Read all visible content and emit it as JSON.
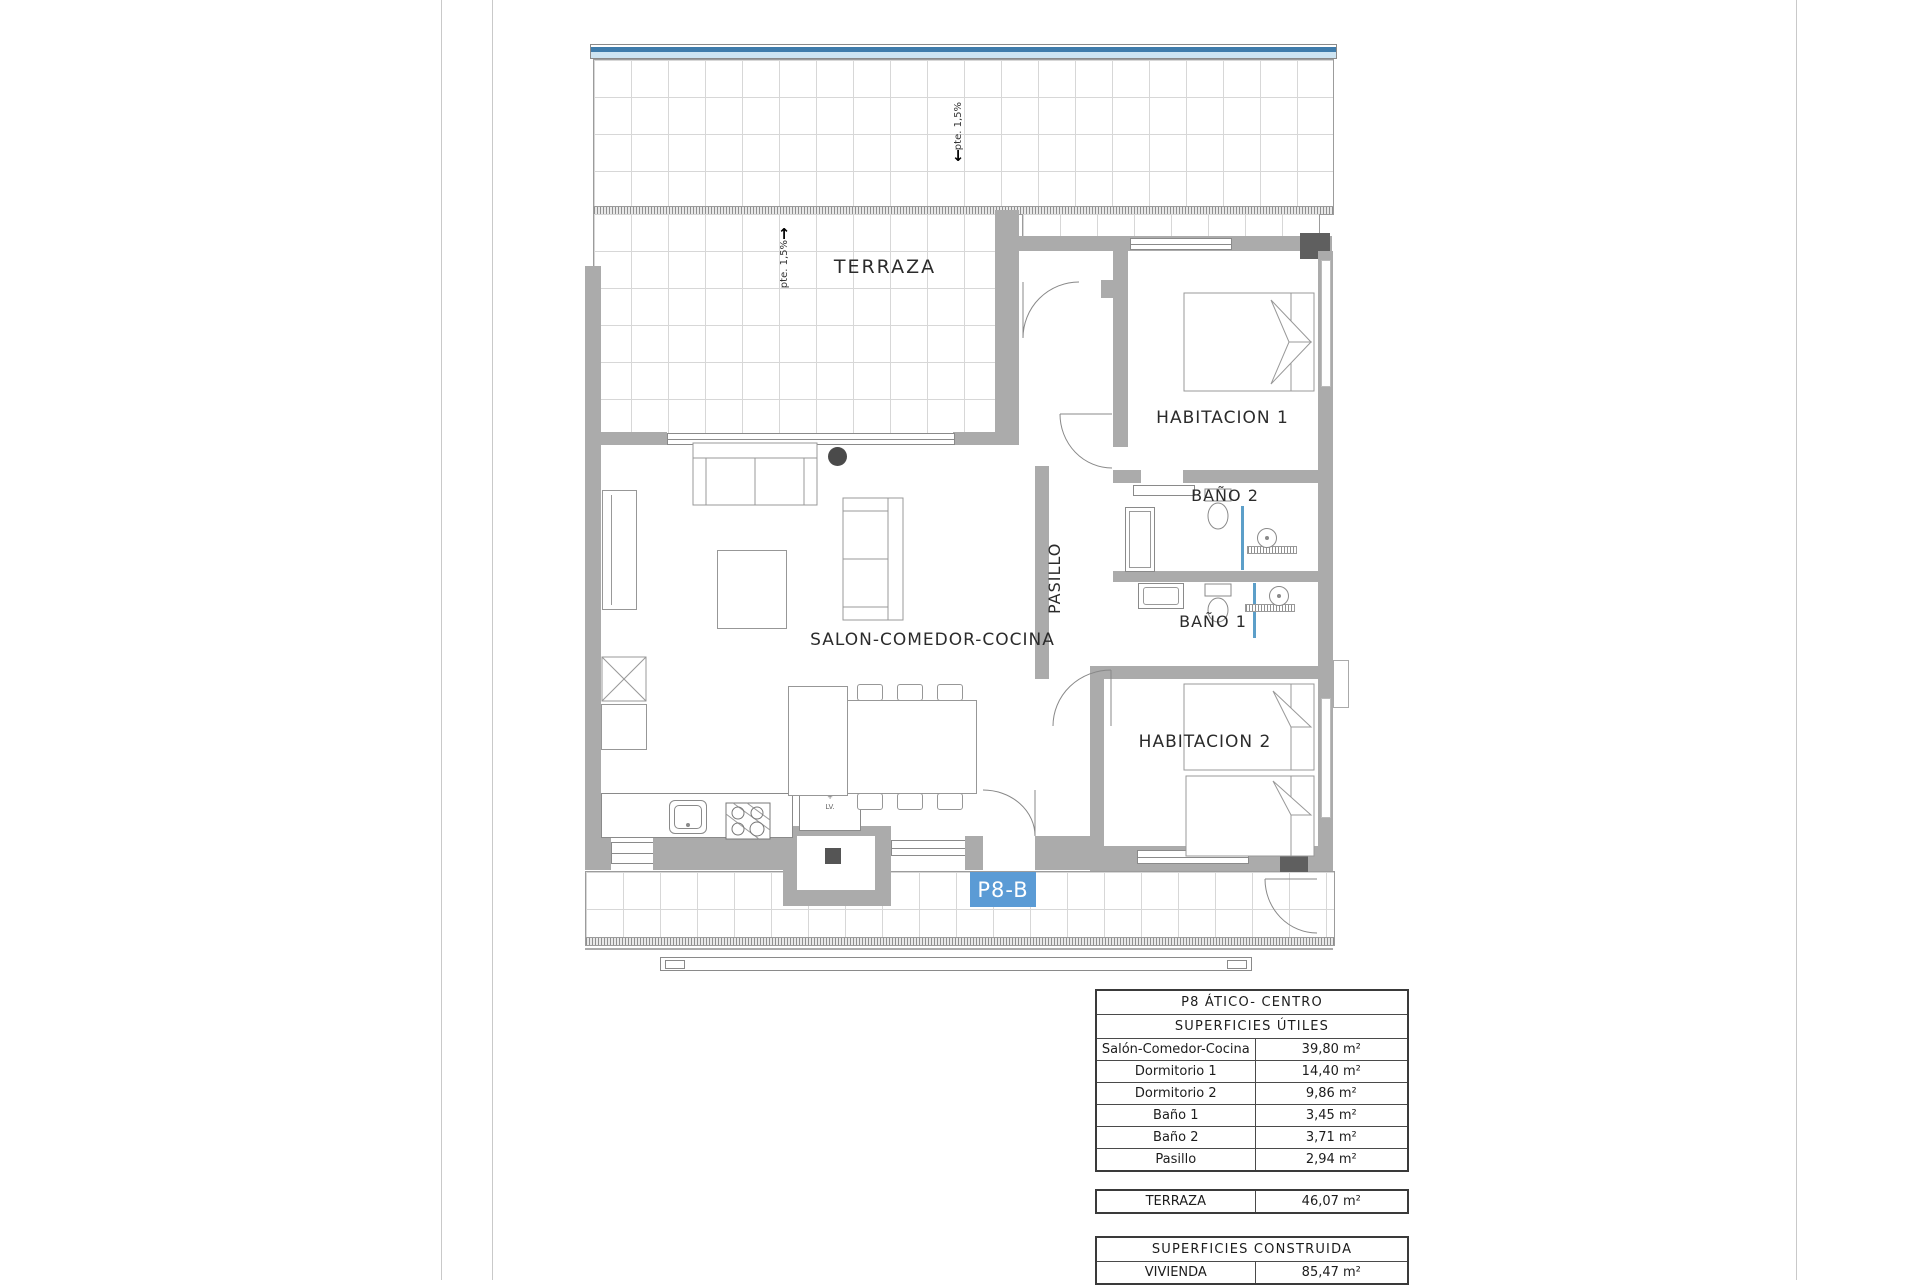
{
  "plan": {
    "unit_label": "P8-B",
    "labels": {
      "terraza": "TERRAZA",
      "habitacion1": "HABITACION 1",
      "habitacion2": "HABITACION 2",
      "bano1": "BAÑO 1",
      "bano2": "BAÑO 2",
      "pasillo": "PASILLO",
      "salon": "SALON-COMEDOR-COCINA"
    },
    "annotations": {
      "slope": "pte. 1,5%",
      "slope_arrow_up": "↑",
      "slope_arrow_down": "↓",
      "laundry_closet_line1": "secadora",
      "laundry_closet_line2": "+",
      "laundry_closet_line3": "LV."
    },
    "colors": {
      "wall_grey": "#ababab",
      "badge_blue": "#5b9bd5",
      "railing_blue_dark": "#3f7cab",
      "railing_blue_light": "#cde4f2",
      "glass_blue": "#5c9fc9"
    }
  },
  "tables": {
    "main": {
      "title": "P8 ÁTICO- CENTRO",
      "subtitle": "SUPERFICIES ÚTILES",
      "rows": [
        {
          "name": "Salón-Comedor-Cocina",
          "area": "39,80 m²"
        },
        {
          "name": "Dormitorio 1",
          "area": "14,40 m²"
        },
        {
          "name": "Dormitorio 2",
          "area": "9,86 m²"
        },
        {
          "name": "Baño 1",
          "area": "3,45 m²"
        },
        {
          "name": "Baño 2",
          "area": "3,71 m²"
        },
        {
          "name": "Pasillo",
          "area": "2,94 m²"
        }
      ]
    },
    "terraza_row": {
      "name": "TERRAZA",
      "area": "46,07 m²"
    },
    "construida": {
      "title": "SUPERFICIES CONSTRUIDA",
      "rows": [
        {
          "name": "VIVIENDA",
          "area": "85,47 m²"
        }
      ]
    }
  }
}
